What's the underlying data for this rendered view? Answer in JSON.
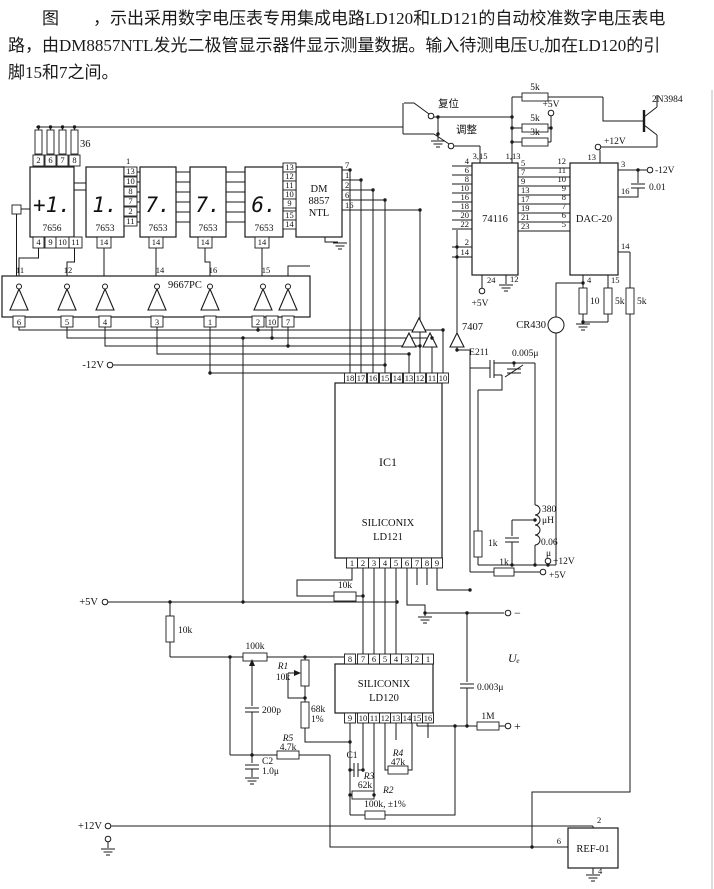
{
  "cap": {
    "l1": "图　　，示出采用数字电压表专用集成电路LD120和LD121的自动校准数字电压表电",
    "l2": "路，由DM8857NTL发光二极管显示器件显示测量数据。输入待测电压Uₑ加在LD120的引",
    "l3": "脚15和7之间。"
  },
  "d1": {
    "digit": "+1.",
    "part": "7656",
    "res": "36",
    "tp": [
      "2",
      "6",
      "7",
      "8"
    ],
    "bp": [
      "4",
      "9",
      "10",
      "11"
    ]
  },
  "d2": {
    "digit": "1.",
    "part": "7653",
    "top": "1",
    "rp": [
      "13",
      "10",
      "8",
      "7",
      "2",
      "11"
    ],
    "bp": "14"
  },
  "d3": {
    "digit": "7.",
    "part": "7653",
    "bp": "14"
  },
  "d4": {
    "digit": "7.",
    "part": "7653",
    "bp": "14"
  },
  "d5": {
    "digit": "6.",
    "part": "7653",
    "bp": "14"
  },
  "dm": {
    "l1": "DM",
    "l2": "8857",
    "l3": "NTL",
    "lp": [
      "13",
      "12",
      "11",
      "10",
      "9",
      "15",
      "14"
    ],
    "rp": [
      "7",
      "1",
      "2",
      "6",
      "16"
    ]
  },
  "inv": {
    "part": "9667PC",
    "tp": [
      "11",
      "12",
      "14",
      "16",
      "15"
    ],
    "bp": [
      "6",
      "5",
      "4",
      "3",
      "1",
      "2",
      "10",
      "7"
    ],
    "neg": "-12V"
  },
  "sw": {
    "reset": "复位",
    "adj": "调整",
    "r1": "5k",
    "r2": "5k",
    "r3": "3k",
    "v": "+5V"
  },
  "q": {
    "name": "2N3984",
    "v": "+12V",
    "pin": "13"
  },
  "u1": {
    "part": "74116",
    "t1": "3,15",
    "t2": "1,13",
    "lp": [
      "4",
      "6",
      "8",
      "10",
      "16",
      "18",
      "20",
      "22",
      "2",
      "14"
    ],
    "rp": [
      "5",
      "7",
      "9",
      "13",
      "17",
      "19",
      "21",
      "23"
    ],
    "b1": "24",
    "b2": "12",
    "v": "+5V"
  },
  "dac": {
    "part": "DAC-20",
    "lp": [
      "12",
      "11",
      "10",
      "9",
      "8",
      "7",
      "6",
      "5"
    ],
    "p3": "3",
    "v": "-12V",
    "c": "0.01",
    "p16": "16",
    "p14": "14",
    "p4": "4",
    "p15": "15",
    "r10": "10",
    "r5a": "5k",
    "r5b": "5k"
  },
  "cr": "CR430",
  "buf": "7407",
  "ic1": {
    "name": "IC1",
    "brand": "SILICONIX",
    "part": "LD121",
    "tp": [
      "18",
      "17",
      "16",
      "15",
      "14",
      "13",
      "12",
      "11",
      "10"
    ],
    "bp": [
      "1",
      "2",
      "3",
      "4",
      "5",
      "6",
      "7",
      "8",
      "9"
    ]
  },
  "e": {
    "part": "E211",
    "c1": "0.005μ",
    "rka": "1k",
    "la": "380",
    "lb": "μH",
    "ca": "0.06",
    "cb": "μ",
    "rkb": "1k",
    "v12": "+12V",
    "v5": "+5V"
  },
  "lf": {
    "v5": "+5V",
    "r10k": "10k",
    "pot": "100k",
    "r1": "R1",
    "r1v": "10k",
    "c200": "200p",
    "r68": "68k",
    "r68p": "1%",
    "r5": "R5",
    "r5v": "4.7k",
    "c2": "C2",
    "c2v": "1.0μ"
  },
  "ld": {
    "brand": "SILICONIX",
    "part": "LD120",
    "r10k": "10k",
    "tp": [
      "8",
      "7",
      "6",
      "5",
      "4",
      "3",
      "2",
      "1"
    ],
    "bp": [
      "9",
      "10",
      "11",
      "12",
      "13",
      "14",
      "15",
      "16"
    ]
  },
  "in": {
    "ue": "Uₑ",
    "c": "0.003μ",
    "r": "1M",
    "plus": "+",
    "minus": "−"
  },
  "bt": {
    "c1": "C1",
    "r3": "R3",
    "r3v": "62k",
    "r2": "R2",
    "r2v": "100k, ±1%",
    "r4": "R4",
    "r4v": "47k",
    "v12": "+12V"
  },
  "ref": {
    "part": "REF-01",
    "p2": "2",
    "p6": "6",
    "p4": "4"
  }
}
